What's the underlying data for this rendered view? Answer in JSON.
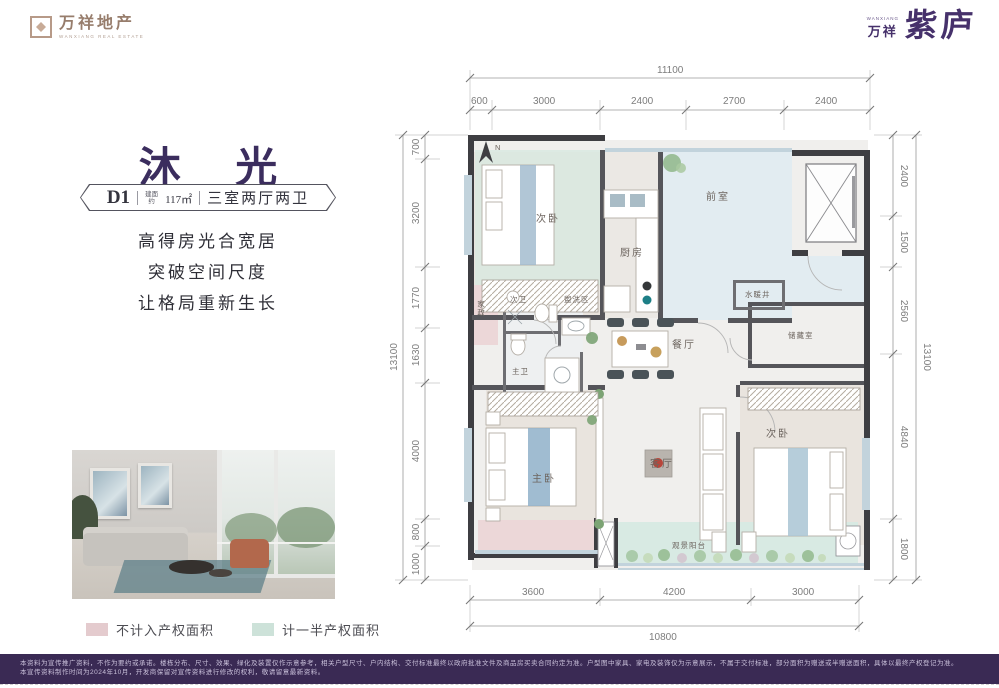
{
  "brand": {
    "logo_left": {
      "name": "万祥地产",
      "sub": "WANXIANG REAL ESTATE"
    },
    "logo_right": {
      "sub": "WANXIANG",
      "prefix": "万祥",
      "name": "紫庐"
    }
  },
  "unit": {
    "title": "沐 光",
    "badge": {
      "code": "D1",
      "area_prefix_l1": "建面",
      "area_prefix_l2": "约",
      "area": "117",
      "area_unit": "㎡",
      "layout": "三室两厅两卫"
    },
    "slogans": [
      "高得房光合宽居",
      "突破空间尺度",
      "让格局重新生长"
    ]
  },
  "legend": {
    "items": [
      {
        "label": "不计入产权面积",
        "color": "#e4cbce"
      },
      {
        "label": "计一半产权面积",
        "color": "#cde2d9"
      }
    ]
  },
  "plan": {
    "north": "N",
    "rooms": {
      "bedroom_top": "次卧",
      "kitchen": "厨房",
      "lobby": "前室",
      "shaft": "水暖井",
      "storage": "储藏室",
      "dining": "餐厅",
      "wash": "盥洗区",
      "bath_second": "次卫",
      "bath_master": "主卫",
      "housekeeping": "家政",
      "living": "客厅",
      "master": "主卧",
      "bedroom_right": "次卧",
      "balcony": "观景阳台"
    },
    "dims": {
      "top": {
        "total": "11100",
        "segments": [
          "600",
          "3000",
          "2400",
          "2700",
          "2400"
        ]
      },
      "bottom": {
        "total": "10800",
        "segments": [
          "3600",
          "4200",
          "3000"
        ]
      },
      "left": {
        "total": "13100",
        "segments": [
          "700",
          "3200",
          "1770",
          "1630",
          "4000",
          "800",
          "1000"
        ]
      },
      "right": {
        "total": "13100",
        "segments": [
          "2400",
          "1500",
          "2560",
          "4840",
          "1800"
        ]
      }
    }
  },
  "colors": {
    "brand_purple": "#46316b",
    "footer_purple": "#3a2a54",
    "tint_half_area": "#d8eae3",
    "tint_no_area": "#ecd7d8",
    "tint_lobby": "#e0ebf1",
    "wall": "#3e3e42"
  },
  "disclaimer": {
    "line1": "本资料为宣传推广资料，不作为要约或承诺。楼栋分布、尺寸、效果、绿化及装置仅作示意参考，相关户型尺寸、户内结构、交付标准最终以政府批准文件及商品房买卖合同约定为准。户型图中家具、家电及装饰仅为示意展示，不属于交付标准，部分面积为赠送或半赠送面积，具体以最终产权登记为准。",
    "line2": "本宣传资料制作时间为2024年10月，开发商保留对宣传资料进行修改的权利，敬请留意最新资料。"
  }
}
